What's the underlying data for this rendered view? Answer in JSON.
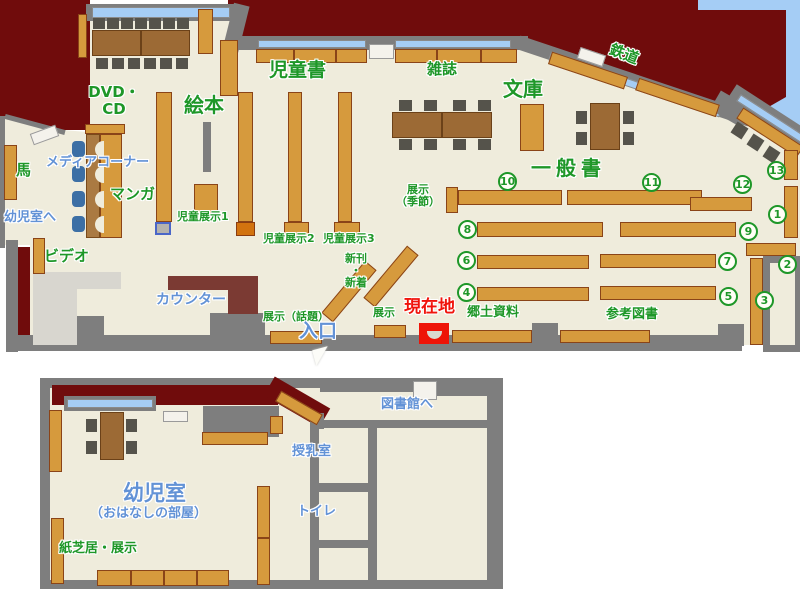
{
  "palette": {
    "dark_red": "#700c0c",
    "floor": "#efecdc",
    "wall_gray": "#7e7e7e",
    "shelf_orange": "#d69a3d",
    "window_blue": "#a5cdf5",
    "green_text": "#1e9728",
    "blue_text": "#6292d6",
    "red_text": "#f0140c",
    "marker_red": "#ee1407"
  },
  "labels": [
    {
      "n": "label-dvd-cd",
      "text": "DVD・\nCD",
      "x": 88,
      "y": 84,
      "c": "g",
      "fs": 15,
      "ctr": true,
      "w": 52
    },
    {
      "n": "label-ehon",
      "text": "絵本",
      "x": 184,
      "y": 94,
      "c": "g",
      "fs": 20
    },
    {
      "n": "label-jidousho",
      "text": "児童書",
      "x": 269,
      "y": 60,
      "c": "g",
      "fs": 19
    },
    {
      "n": "label-zasshi",
      "text": "雑誌",
      "x": 427,
      "y": 61,
      "c": "g",
      "fs": 15
    },
    {
      "n": "label-bunko",
      "text": "文庫",
      "x": 503,
      "y": 78,
      "c": "g",
      "fs": 20
    },
    {
      "n": "label-ippansho",
      "text": "一般書",
      "x": 531,
      "y": 157,
      "c": "g",
      "fs": 20,
      "ls": 5
    },
    {
      "n": "label-tetsudou",
      "text": "鉄道",
      "x": 609,
      "y": 46,
      "c": "g",
      "fs": 15,
      "rot": 21
    },
    {
      "n": "label-media-corner",
      "text": "メディアコーナー",
      "x": 46,
      "y": 156,
      "c": "b",
      "fs": 13
    },
    {
      "n": "label-manga",
      "text": "マンガ",
      "x": 110,
      "y": 186,
      "c": "g",
      "fs": 15
    },
    {
      "n": "label-uma",
      "text": "馬",
      "x": 16,
      "y": 162,
      "c": "g",
      "fs": 15
    },
    {
      "n": "label-youjishitsu-e",
      "text": "幼児室へ",
      "x": 4,
      "y": 211,
      "c": "b",
      "fs": 13
    },
    {
      "n": "label-video",
      "text": "ビデオ",
      "x": 44,
      "y": 248,
      "c": "g",
      "fs": 15
    },
    {
      "n": "label-jidou-tenji1",
      "text": "児童展示1",
      "x": 177,
      "y": 211,
      "c": "g",
      "fs": 11
    },
    {
      "n": "label-jidou-tenji2",
      "text": "児童展示2",
      "x": 263,
      "y": 233,
      "c": "g",
      "fs": 11
    },
    {
      "n": "label-jidou-tenji3",
      "text": "児童展示3",
      "x": 323,
      "y": 233,
      "c": "g",
      "fs": 11
    },
    {
      "n": "label-shinkan-shinchaku",
      "text": "新刊\n・\n新着",
      "x": 338,
      "y": 253,
      "c": "g",
      "fs": 11,
      "ctr": true,
      "w": 36
    },
    {
      "n": "label-tenji-kisetsu",
      "text": "展示\n（季節）",
      "x": 392,
      "y": 184,
      "c": "g",
      "fs": 11,
      "ctr": true,
      "w": 52
    },
    {
      "n": "label-tenji-wadai",
      "text": "展示（話題）",
      "x": 263,
      "y": 311,
      "c": "g",
      "fs": 11
    },
    {
      "n": "label-tenji",
      "text": "展示",
      "x": 373,
      "y": 307,
      "c": "g",
      "fs": 11
    },
    {
      "n": "label-genzaichi",
      "text": "現在地",
      "x": 404,
      "y": 298,
      "c": "r",
      "fs": 17
    },
    {
      "n": "label-iriguchi",
      "text": "入口",
      "x": 299,
      "y": 321,
      "c": "b",
      "fs": 19
    },
    {
      "n": "label-counter",
      "text": "カウンター",
      "x": 156,
      "y": 293,
      "c": "b",
      "fs": 14
    },
    {
      "n": "label-kyoudo-shiryou",
      "text": "郷土資料",
      "x": 467,
      "y": 306,
      "c": "g",
      "fs": 13
    },
    {
      "n": "label-sankou-tosho",
      "text": "参考図書",
      "x": 606,
      "y": 308,
      "c": "g",
      "fs": 13
    },
    {
      "n": "label-toshokan-e",
      "text": "図書館へ",
      "x": 381,
      "y": 398,
      "c": "b",
      "fs": 13
    },
    {
      "n": "label-junyuushitsu",
      "text": "授乳室",
      "x": 292,
      "y": 445,
      "c": "b",
      "fs": 13
    },
    {
      "n": "label-toilet",
      "text": "トイレ",
      "x": 297,
      "y": 505,
      "c": "b",
      "fs": 13
    },
    {
      "n": "label-youjishitsu",
      "text": "幼児室",
      "x": 123,
      "y": 482,
      "c": "b",
      "fs": 21
    },
    {
      "n": "label-ohanashi",
      "text": "（おはなしの部屋）",
      "x": 90,
      "y": 507,
      "c": "b",
      "fs": 13
    },
    {
      "n": "label-kamishibai",
      "text": "紙芝居・展示",
      "x": 59,
      "y": 542,
      "c": "g",
      "fs": 13
    }
  ],
  "numbers": [
    {
      "n": "10",
      "x": 498,
      "y": 172
    },
    {
      "n": "11",
      "x": 642,
      "y": 173
    },
    {
      "n": "12",
      "x": 733,
      "y": 175
    },
    {
      "n": "13",
      "x": 767,
      "y": 161
    },
    {
      "n": "1",
      "x": 768,
      "y": 205
    },
    {
      "n": "2",
      "x": 778,
      "y": 255
    },
    {
      "n": "3",
      "x": 755,
      "y": 291
    },
    {
      "n": "4",
      "x": 457,
      "y": 283
    },
    {
      "n": "5",
      "x": 719,
      "y": 287
    },
    {
      "n": "6",
      "x": 457,
      "y": 251
    },
    {
      "n": "7",
      "x": 718,
      "y": 252
    },
    {
      "n": "8",
      "x": 458,
      "y": 220
    },
    {
      "n": "9",
      "x": 739,
      "y": 222
    }
  ],
  "shapes": [
    {
      "t": "wall",
      "x": 35,
      "y": 124,
      "w": 62,
      "h": 5,
      "r": 15
    },
    {
      "t": "wall",
      "x": 0,
      "y": 116,
      "w": 5,
      "h": 132
    },
    {
      "t": "wall",
      "x": 86,
      "y": 4,
      "w": 150,
      "h": 17
    },
    {
      "t": "win",
      "x": 92,
      "y": 7,
      "w": 138,
      "h": 11
    },
    {
      "t": "wall",
      "x": 236,
      "y": 28,
      "w": 16,
      "h": 48,
      "r": 14
    },
    {
      "t": "wall",
      "x": 236,
      "y": 36,
      "w": 292,
      "h": 14
    },
    {
      "t": "win",
      "x": 258,
      "y": 40,
      "w": 108,
      "h": 8
    },
    {
      "t": "win",
      "x": 395,
      "y": 40,
      "w": 116,
      "h": 8
    },
    {
      "t": "door",
      "x": 369,
      "y": 44,
      "w": 25,
      "h": 15
    },
    {
      "t": "wall",
      "x": 634,
      "y": 81,
      "w": 244,
      "h": 14,
      "r": 18.5
    },
    {
      "t": "win",
      "x": 635,
      "y": 85,
      "w": 180,
      "h": 8,
      "r": 18.5
    },
    {
      "t": "wall",
      "x": 731,
      "y": 109,
      "w": 36,
      "h": 22,
      "r": 30
    },
    {
      "t": "wall",
      "x": 771,
      "y": 116,
      "w": 92,
      "h": 16,
      "r": 33
    },
    {
      "t": "win",
      "x": 773,
      "y": 120,
      "w": 82,
      "h": 8,
      "r": 33
    },
    {
      "t": "door",
      "x": 591,
      "y": 57,
      "w": 27,
      "h": 12,
      "r": 18.5
    },
    {
      "t": "shelf",
      "x": 588,
      "y": 70,
      "w": 80,
      "h": 13,
      "r": 18.5
    },
    {
      "t": "shelf",
      "x": 677,
      "y": 97,
      "w": 85,
      "h": 13,
      "r": 18.5
    },
    {
      "t": "shelf",
      "x": 770,
      "y": 132,
      "w": 72,
      "h": 13,
      "r": 33
    },
    {
      "t": "chair",
      "x": 739,
      "y": 130,
      "w": 13,
      "h": 13,
      "r": 33
    },
    {
      "t": "chair",
      "x": 755,
      "y": 142,
      "w": 13,
      "h": 13,
      "r": 33
    },
    {
      "t": "chair",
      "x": 771,
      "y": 154,
      "w": 13,
      "h": 13,
      "r": 33
    },
    {
      "t": "wall",
      "x": 6,
      "y": 240,
      "w": 12,
      "h": 112
    },
    {
      "t": "red",
      "x": 18,
      "y": 247,
      "w": 12,
      "h": 95
    },
    {
      "t": "wall",
      "x": 18,
      "y": 335,
      "w": 724,
      "h": 16
    },
    {
      "t": "wall",
      "x": 62,
      "y": 316,
      "w": 42,
      "h": 19
    },
    {
      "t": "wall",
      "x": 210,
      "y": 313,
      "w": 55,
      "h": 22
    },
    {
      "t": "wall",
      "x": 532,
      "y": 323,
      "w": 26,
      "h": 20
    },
    {
      "t": "wall",
      "x": 718,
      "y": 324,
      "w": 26,
      "h": 22
    },
    {
      "t": "wall",
      "x": 763,
      "y": 256,
      "w": 37,
      "h": 96
    },
    {
      "t": "alcove",
      "x": 770,
      "y": 263,
      "w": 25,
      "h": 82
    },
    {
      "t": "lobby",
      "x": 33,
      "y": 272,
      "w": 88,
      "h": 17
    },
    {
      "t": "lobby",
      "x": 33,
      "y": 289,
      "w": 44,
      "h": 56
    },
    {
      "t": "counter",
      "x": 168,
      "y": 276,
      "w": 64,
      "h": 14
    },
    {
      "t": "counter",
      "x": 228,
      "y": 276,
      "w": 30,
      "h": 38
    },
    {
      "t": "door",
      "x": 44,
      "y": 135,
      "w": 27,
      "h": 12,
      "r": -20
    },
    {
      "t": "shelf",
      "x": 78,
      "y": 14,
      "w": 9,
      "h": 44
    },
    {
      "t": "shelf",
      "x": 198,
      "y": 9,
      "w": 15,
      "h": 45
    },
    {
      "t": "shelf",
      "x": 220,
      "y": 40,
      "w": 18,
      "h": 56
    },
    {
      "t": "table",
      "x": 92,
      "y": 30,
      "w": 49,
      "h": 26
    },
    {
      "t": "table",
      "x": 141,
      "y": 30,
      "w": 49,
      "h": 26
    },
    {
      "t": "chair",
      "x": 93,
      "y": 18,
      "w": 12,
      "h": 11
    },
    {
      "t": "chair",
      "x": 107,
      "y": 18,
      "w": 12,
      "h": 11
    },
    {
      "t": "chair",
      "x": 121,
      "y": 18,
      "w": 12,
      "h": 11
    },
    {
      "t": "chair",
      "x": 135,
      "y": 18,
      "w": 12,
      "h": 11
    },
    {
      "t": "chair",
      "x": 149,
      "y": 18,
      "w": 12,
      "h": 11
    },
    {
      "t": "chair",
      "x": 163,
      "y": 18,
      "w": 12,
      "h": 11
    },
    {
      "t": "chair",
      "x": 177,
      "y": 18,
      "w": 12,
      "h": 11
    },
    {
      "t": "chair",
      "x": 96,
      "y": 58,
      "w": 12,
      "h": 11
    },
    {
      "t": "chair",
      "x": 112,
      "y": 58,
      "w": 12,
      "h": 11
    },
    {
      "t": "chair",
      "x": 128,
      "y": 58,
      "w": 12,
      "h": 11
    },
    {
      "t": "chair",
      "x": 144,
      "y": 58,
      "w": 12,
      "h": 11
    },
    {
      "t": "chair",
      "x": 160,
      "y": 58,
      "w": 12,
      "h": 11
    },
    {
      "t": "chair",
      "x": 176,
      "y": 58,
      "w": 12,
      "h": 11
    },
    {
      "t": "shelf",
      "x": 85,
      "y": 124,
      "w": 40,
      "h": 10
    },
    {
      "t": "mcol",
      "x": 86,
      "y": 134,
      "w": 14,
      "h": 104
    },
    {
      "t": "shelf",
      "x": 100,
      "y": 134,
      "w": 22,
      "h": 104
    },
    {
      "t": "seatarc",
      "x": 95,
      "y": 141,
      "w": 9,
      "h": 17
    },
    {
      "t": "seatarc",
      "x": 95,
      "y": 166,
      "w": 9,
      "h": 17
    },
    {
      "t": "seatarc",
      "x": 95,
      "y": 191,
      "w": 9,
      "h": 17
    },
    {
      "t": "seatarc",
      "x": 95,
      "y": 216,
      "w": 9,
      "h": 17
    },
    {
      "t": "bchair",
      "x": 72,
      "y": 141,
      "w": 13,
      "h": 16
    },
    {
      "t": "bchair",
      "x": 72,
      "y": 166,
      "w": 13,
      "h": 16
    },
    {
      "t": "bchair",
      "x": 72,
      "y": 191,
      "w": 13,
      "h": 16
    },
    {
      "t": "bchair",
      "x": 72,
      "y": 216,
      "w": 13,
      "h": 16
    },
    {
      "t": "shelf",
      "x": 156,
      "y": 92,
      "w": 16,
      "h": 130
    },
    {
      "t": "graybox",
      "x": 155,
      "y": 222,
      "w": 16,
      "h": 13
    },
    {
      "t": "wall",
      "x": 203,
      "y": 122,
      "w": 8,
      "h": 50
    },
    {
      "t": "shelf",
      "x": 194,
      "y": 184,
      "w": 24,
      "h": 31
    },
    {
      "t": "shelf",
      "x": 238,
      "y": 92,
      "w": 15,
      "h": 130
    },
    {
      "t": "shelf2",
      "x": 236,
      "y": 222,
      "w": 19,
      "h": 14
    },
    {
      "t": "shelf",
      "x": 288,
      "y": 92,
      "w": 14,
      "h": 130
    },
    {
      "t": "shelf",
      "x": 284,
      "y": 222,
      "w": 25,
      "h": 14
    },
    {
      "t": "shelf",
      "x": 338,
      "y": 92,
      "w": 14,
      "h": 130
    },
    {
      "t": "shelf",
      "x": 334,
      "y": 222,
      "w": 26,
      "h": 14
    },
    {
      "t": "shelf",
      "x": 256,
      "y": 49,
      "w": 38,
      "h": 14
    },
    {
      "t": "shelf",
      "x": 294,
      "y": 49,
      "w": 42,
      "h": 14
    },
    {
      "t": "shelf",
      "x": 336,
      "y": 49,
      "w": 31,
      "h": 14
    },
    {
      "t": "shelf",
      "x": 395,
      "y": 49,
      "w": 42,
      "h": 14
    },
    {
      "t": "shelf",
      "x": 437,
      "y": 49,
      "w": 44,
      "h": 14
    },
    {
      "t": "shelf",
      "x": 481,
      "y": 49,
      "w": 36,
      "h": 14
    },
    {
      "t": "shelf",
      "x": 520,
      "y": 104,
      "w": 24,
      "h": 47
    },
    {
      "t": "table",
      "x": 392,
      "y": 112,
      "w": 50,
      "h": 26
    },
    {
      "t": "table",
      "x": 442,
      "y": 112,
      "w": 50,
      "h": 26
    },
    {
      "t": "chair",
      "x": 399,
      "y": 100,
      "w": 13,
      "h": 11
    },
    {
      "t": "chair",
      "x": 424,
      "y": 100,
      "w": 13,
      "h": 11
    },
    {
      "t": "chair",
      "x": 453,
      "y": 100,
      "w": 13,
      "h": 11
    },
    {
      "t": "chair",
      "x": 478,
      "y": 100,
      "w": 13,
      "h": 11
    },
    {
      "t": "chair",
      "x": 399,
      "y": 139,
      "w": 13,
      "h": 11
    },
    {
      "t": "chair",
      "x": 424,
      "y": 139,
      "w": 13,
      "h": 11
    },
    {
      "t": "chair",
      "x": 453,
      "y": 139,
      "w": 13,
      "h": 11
    },
    {
      "t": "chair",
      "x": 478,
      "y": 139,
      "w": 13,
      "h": 11
    },
    {
      "t": "table",
      "x": 590,
      "y": 103,
      "w": 30,
      "h": 47
    },
    {
      "t": "chair",
      "x": 576,
      "y": 111,
      "w": 11,
      "h": 13
    },
    {
      "t": "chair",
      "x": 576,
      "y": 132,
      "w": 11,
      "h": 13
    },
    {
      "t": "chair",
      "x": 623,
      "y": 111,
      "w": 11,
      "h": 13
    },
    {
      "t": "chair",
      "x": 623,
      "y": 132,
      "w": 11,
      "h": 13
    },
    {
      "t": "shelf",
      "x": 446,
      "y": 187,
      "w": 12,
      "h": 26
    },
    {
      "t": "shelf",
      "x": 458,
      "y": 190,
      "w": 104,
      "h": 15
    },
    {
      "t": "shelf",
      "x": 567,
      "y": 190,
      "w": 135,
      "h": 15
    },
    {
      "t": "shelf",
      "x": 690,
      "y": 197,
      "w": 62,
      "h": 14
    },
    {
      "t": "shelf",
      "x": 477,
      "y": 222,
      "w": 126,
      "h": 15
    },
    {
      "t": "shelf",
      "x": 620,
      "y": 222,
      "w": 116,
      "h": 15
    },
    {
      "t": "shelf",
      "x": 477,
      "y": 255,
      "w": 112,
      "h": 14
    },
    {
      "t": "shelf",
      "x": 600,
      "y": 254,
      "w": 116,
      "h": 14
    },
    {
      "t": "shelf",
      "x": 477,
      "y": 287,
      "w": 112,
      "h": 14
    },
    {
      "t": "shelf",
      "x": 600,
      "y": 286,
      "w": 116,
      "h": 14
    },
    {
      "t": "shelf",
      "x": 784,
      "y": 150,
      "w": 14,
      "h": 30
    },
    {
      "t": "shelf",
      "x": 784,
      "y": 186,
      "w": 14,
      "h": 52
    },
    {
      "t": "shelf",
      "x": 746,
      "y": 243,
      "w": 50,
      "h": 13
    },
    {
      "t": "shelf",
      "x": 750,
      "y": 258,
      "w": 13,
      "h": 87
    },
    {
      "t": "shelf",
      "x": 349,
      "y": 291,
      "w": 68,
      "h": 15,
      "r": -50
    },
    {
      "t": "shelf",
      "x": 391,
      "y": 276,
      "w": 68,
      "h": 15,
      "r": -50
    },
    {
      "t": "shelf",
      "x": 270,
      "y": 331,
      "w": 52,
      "h": 13
    },
    {
      "t": "shelf",
      "x": 374,
      "y": 325,
      "w": 32,
      "h": 13
    },
    {
      "t": "shelf",
      "x": 452,
      "y": 330,
      "w": 80,
      "h": 13
    },
    {
      "t": "shelf",
      "x": 560,
      "y": 330,
      "w": 90,
      "h": 13
    },
    {
      "t": "shelf",
      "x": 33,
      "y": 238,
      "w": 12,
      "h": 36
    },
    {
      "t": "shelf",
      "x": 4,
      "y": 145,
      "w": 13,
      "h": 55
    },
    {
      "t": "marker",
      "x": 419,
      "y": 323,
      "w": 30,
      "h": 21
    },
    {
      "t": "bowl",
      "x": 427,
      "y": 331,
      "w": 15,
      "h": 8
    },
    {
      "t": "wall",
      "x": 40,
      "y": 378,
      "w": 463,
      "h": 211
    },
    {
      "t": "floor2",
      "x": 50,
      "y": 388,
      "w": 443,
      "h": 192
    },
    {
      "t": "red",
      "x": 52,
      "y": 385,
      "w": 226,
      "h": 20
    },
    {
      "t": "red",
      "x": 297,
      "y": 402,
      "w": 64,
      "h": 22,
      "r": 30
    },
    {
      "t": "wall",
      "x": 203,
      "y": 406,
      "w": 76,
      "h": 31
    },
    {
      "t": "wall",
      "x": 320,
      "y": 382,
      "w": 100,
      "h": 10
    },
    {
      "t": "door",
      "x": 413,
      "y": 381,
      "w": 24,
      "h": 19
    },
    {
      "t": "wall",
      "x": 437,
      "y": 384,
      "w": 54,
      "h": 12
    },
    {
      "t": "wall",
      "x": 487,
      "y": 384,
      "w": 16,
      "h": 204
    },
    {
      "t": "wall",
      "x": 312,
      "y": 413,
      "w": 12,
      "h": 16
    },
    {
      "t": "wall",
      "x": 310,
      "y": 420,
      "w": 177,
      "h": 8
    },
    {
      "t": "wall",
      "x": 310,
      "y": 420,
      "w": 9,
      "h": 160
    },
    {
      "t": "wall",
      "x": 368,
      "y": 420,
      "w": 9,
      "h": 160
    },
    {
      "t": "wall",
      "x": 310,
      "y": 483,
      "w": 67,
      "h": 9
    },
    {
      "t": "wall",
      "x": 310,
      "y": 540,
      "w": 67,
      "h": 8
    },
    {
      "t": "wall",
      "x": 64,
      "y": 396,
      "w": 92,
      "h": 15
    },
    {
      "t": "win",
      "x": 67,
      "y": 399,
      "w": 86,
      "h": 9
    },
    {
      "t": "door",
      "x": 163,
      "y": 411,
      "w": 25,
      "h": 11
    },
    {
      "t": "table",
      "x": 100,
      "y": 412,
      "w": 24,
      "h": 48
    },
    {
      "t": "chair",
      "x": 86,
      "y": 419,
      "w": 11,
      "h": 13
    },
    {
      "t": "chair",
      "x": 126,
      "y": 419,
      "w": 11,
      "h": 13
    },
    {
      "t": "chair",
      "x": 86,
      "y": 441,
      "w": 11,
      "h": 13
    },
    {
      "t": "chair",
      "x": 126,
      "y": 441,
      "w": 11,
      "h": 13
    },
    {
      "t": "shelf",
      "x": 49,
      "y": 410,
      "w": 13,
      "h": 62
    },
    {
      "t": "shelf",
      "x": 51,
      "y": 518,
      "w": 13,
      "h": 66
    },
    {
      "t": "shelf",
      "x": 97,
      "y": 570,
      "w": 34,
      "h": 16
    },
    {
      "t": "shelf",
      "x": 131,
      "y": 570,
      "w": 33,
      "h": 16
    },
    {
      "t": "shelf",
      "x": 164,
      "y": 570,
      "w": 33,
      "h": 16
    },
    {
      "t": "shelf",
      "x": 197,
      "y": 570,
      "w": 32,
      "h": 16
    },
    {
      "t": "shelf",
      "x": 257,
      "y": 486,
      "w": 13,
      "h": 52
    },
    {
      "t": "shelf",
      "x": 257,
      "y": 538,
      "w": 13,
      "h": 47
    },
    {
      "t": "shelf",
      "x": 202,
      "y": 432,
      "w": 66,
      "h": 13
    },
    {
      "t": "shelf",
      "x": 270,
      "y": 416,
      "w": 13,
      "h": 18
    },
    {
      "t": "shelf",
      "x": 299,
      "y": 408,
      "w": 48,
      "h": 12,
      "r": 30
    }
  ]
}
